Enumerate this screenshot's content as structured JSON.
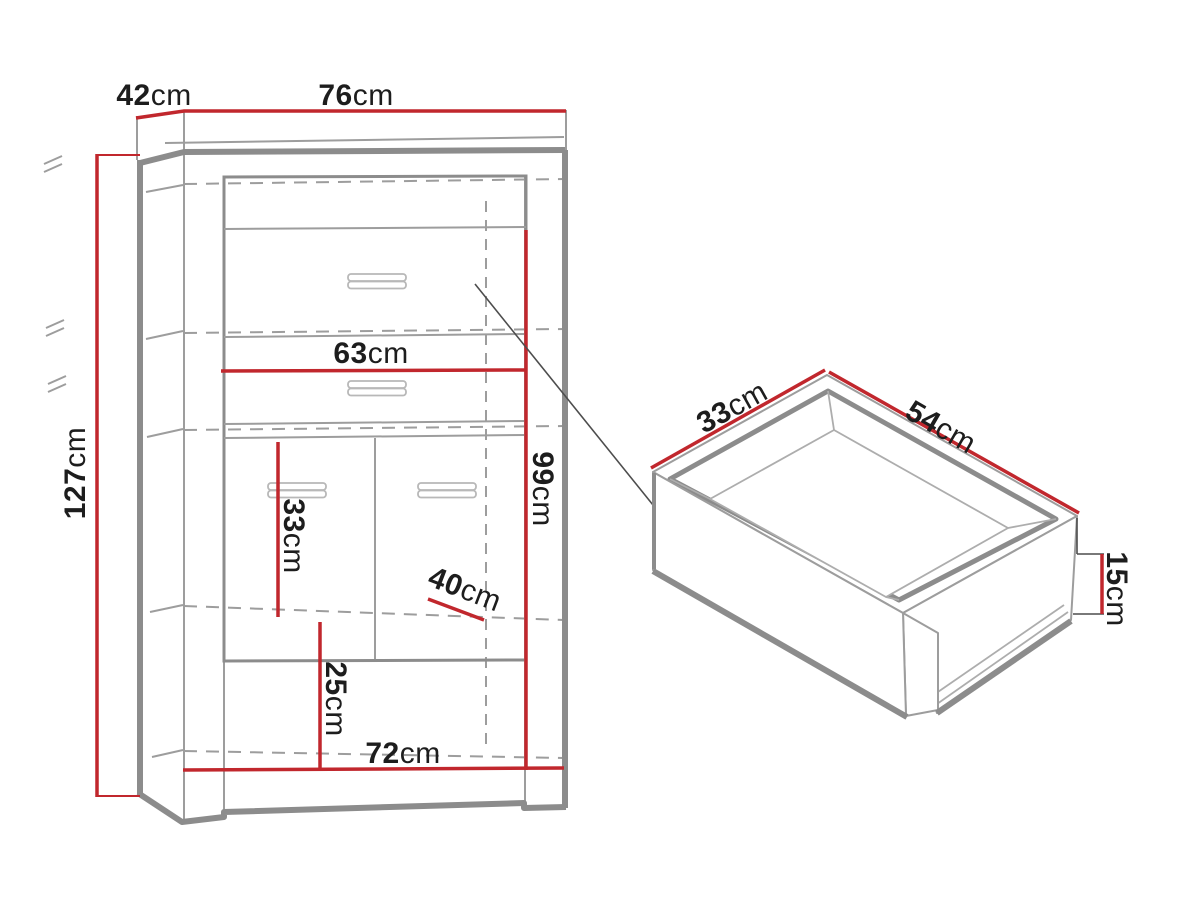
{
  "diagram": {
    "type": "furniture-technical-drawing",
    "unit": "cm",
    "colors": {
      "background": "#ffffff",
      "dimension": "#c1272d",
      "outline_dark": "#8c8c8c",
      "outline_mid": "#9d9d9d",
      "outline_light": "#adadad",
      "leader": "#4d4d4d",
      "text": "#1d1d1d"
    },
    "cabinet": {
      "view": "front perspective",
      "dimensions": {
        "depth": {
          "value": "42",
          "unit": "cm"
        },
        "width": {
          "value": "76",
          "unit": "cm"
        },
        "height": {
          "value": "127",
          "unit": "cm"
        },
        "shelf_width": {
          "value": "63",
          "unit": "cm"
        },
        "interior_height": {
          "value": "99",
          "unit": "cm"
        },
        "middle_section_height": {
          "value": "33",
          "unit": "cm"
        },
        "interior_depth": {
          "value": "40",
          "unit": "cm"
        },
        "bottom_section_height": {
          "value": "25",
          "unit": "cm"
        },
        "interior_width": {
          "value": "72",
          "unit": "cm"
        }
      }
    },
    "drawer": {
      "view": "isometric",
      "dimensions": {
        "depth": {
          "value": "33",
          "unit": "cm"
        },
        "width": {
          "value": "54",
          "unit": "cm"
        },
        "height": {
          "value": "15",
          "unit": "cm"
        }
      }
    }
  }
}
